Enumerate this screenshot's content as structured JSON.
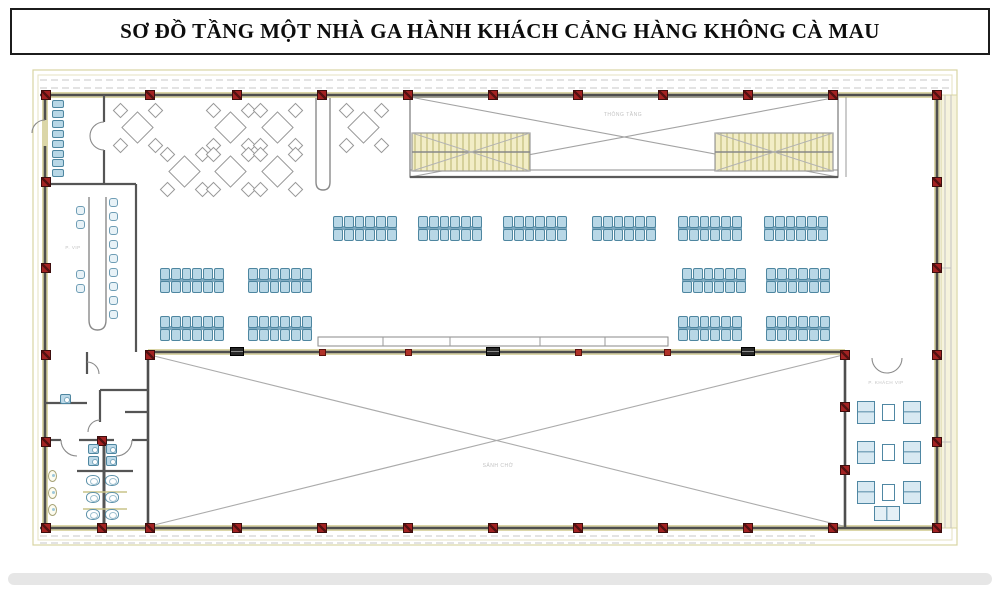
{
  "title": "SƠ ĐỒ TẦNG MỘT NHÀ GA HÀNH KHÁCH CẢNG HÀNG KHÔNG CÀ MAU",
  "labels": {
    "void_upper": "THÔNG TẦNG",
    "main_hall": "SẢNH CHỜ",
    "vip_room_right": "P. KHÁCH VIP",
    "vip_room_left": "P. VIP"
  },
  "colors": {
    "column_red": "#a32222",
    "seat_blue": "#b8d7e6",
    "seat_border": "#4e86a0",
    "stair_fill": "#f2edc6",
    "stair_line": "#c9c386",
    "wall_gray": "#4e4e4e",
    "envelope_khaki": "#d8d4a4"
  },
  "plan": {
    "columns": [
      [
        46,
        95
      ],
      [
        150,
        95
      ],
      [
        237,
        95
      ],
      [
        322,
        95
      ],
      [
        408,
        95
      ],
      [
        493,
        95
      ],
      [
        578,
        95
      ],
      [
        663,
        95
      ],
      [
        748,
        95
      ],
      [
        833,
        95
      ],
      [
        937,
        95
      ],
      [
        46,
        528
      ],
      [
        102,
        528
      ],
      [
        150,
        528
      ],
      [
        237,
        528
      ],
      [
        322,
        528
      ],
      [
        408,
        528
      ],
      [
        493,
        528
      ],
      [
        578,
        528
      ],
      [
        663,
        528
      ],
      [
        748,
        528
      ],
      [
        833,
        528
      ],
      [
        937,
        528
      ],
      [
        46,
        182
      ],
      [
        46,
        268
      ],
      [
        46,
        355
      ],
      [
        46,
        442
      ],
      [
        937,
        182
      ],
      [
        937,
        268
      ],
      [
        937,
        355
      ],
      [
        937,
        442
      ],
      [
        150,
        355
      ],
      [
        845,
        355
      ],
      [
        845,
        407
      ],
      [
        845,
        470
      ],
      [
        102,
        441
      ]
    ],
    "ticks": [
      [
        322,
        352
      ],
      [
        408,
        352
      ],
      [
        578,
        352
      ],
      [
        667,
        352
      ]
    ],
    "gates": [
      [
        237,
        351
      ],
      [
        493,
        351
      ],
      [
        748,
        351
      ]
    ],
    "seat_banks": [
      [
        333,
        216
      ],
      [
        418,
        216
      ],
      [
        503,
        216
      ],
      [
        592,
        216
      ],
      [
        678,
        216
      ],
      [
        764,
        216
      ],
      [
        160,
        268
      ],
      [
        248,
        268
      ],
      [
        682,
        268
      ],
      [
        766,
        268
      ],
      [
        160,
        316
      ],
      [
        248,
        316
      ],
      [
        678,
        316
      ],
      [
        766,
        316
      ]
    ],
    "dining_tables": [
      [
        138,
        128
      ],
      [
        231,
        128
      ],
      [
        278,
        128
      ],
      [
        364,
        128
      ],
      [
        185,
        172
      ],
      [
        231,
        172
      ],
      [
        278,
        172
      ]
    ],
    "seat_strip": {
      "x": 52,
      "y": 100,
      "w": 12,
      "h": 8,
      "count": 8,
      "dy": 9.9
    },
    "left_table_chairs": [
      [
        109,
        198
      ],
      [
        109,
        212
      ],
      [
        109,
        226
      ],
      [
        109,
        240
      ],
      [
        109,
        254
      ],
      [
        109,
        268
      ],
      [
        109,
        282
      ],
      [
        109,
        296
      ],
      [
        109,
        310
      ],
      [
        76,
        206
      ],
      [
        76,
        220
      ],
      [
        76,
        270
      ],
      [
        76,
        284
      ]
    ],
    "toilet": {
      "sinks": [
        [
          88,
          444
        ],
        [
          88,
          456
        ],
        [
          106,
          444
        ],
        [
          106,
          456
        ],
        [
          60,
          394
        ]
      ],
      "wcs": [
        [
          86,
          475
        ],
        [
          86,
          492
        ],
        [
          86,
          509
        ],
        [
          105,
          475
        ],
        [
          105,
          492
        ],
        [
          105,
          509
        ]
      ],
      "urinals": [
        [
          48,
          470
        ],
        [
          48,
          487
        ],
        [
          48,
          504
        ]
      ]
    },
    "vip_room": {
      "rows": [
        401,
        441,
        481
      ],
      "sofa_x": [
        857,
        903
      ],
      "table_x": 882,
      "bottom_table": [
        874,
        506,
        26,
        15
      ]
    }
  }
}
